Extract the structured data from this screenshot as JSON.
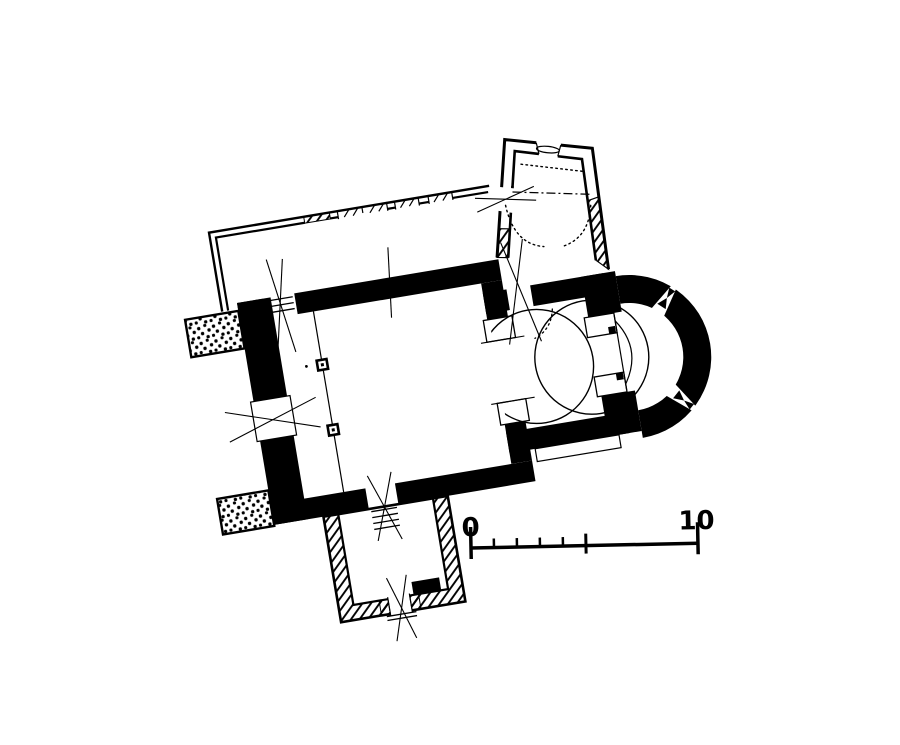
{
  "plan": {
    "kind": "church floor plan, ink drawing",
    "colors": {
      "ink": "#000000",
      "paper": "#ffffff"
    }
  },
  "scale_bar": {
    "start_label": "0",
    "end_label": "10",
    "minor_divisions": 5
  }
}
